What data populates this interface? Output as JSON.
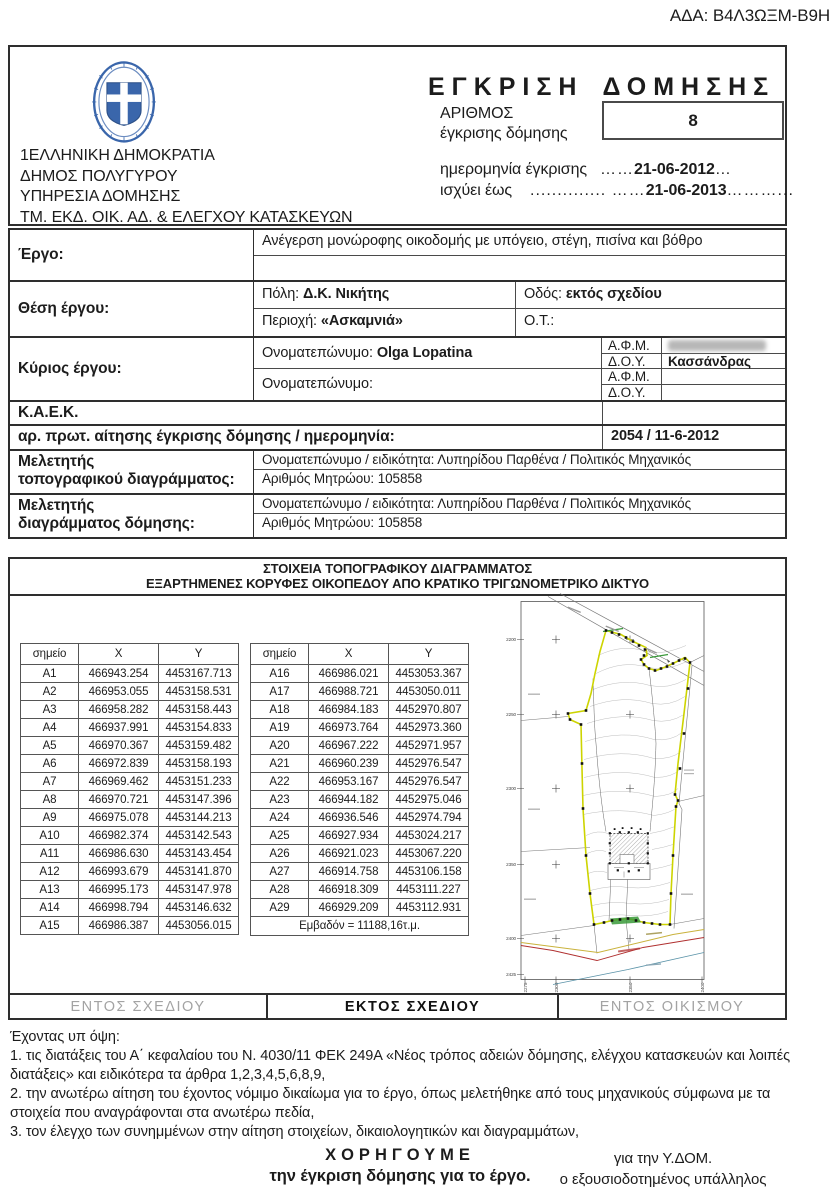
{
  "ada": "ΑΔΑ: Β4Λ3ΩΞΜ-Β9Η",
  "header": {
    "authority_lines": [
      "1ΕΛΛΗΝΙΚΗ ΔΗΜΟΚΡΑΤΙΑ",
      "ΔΗΜΟΣ ΠΟΛΥΓΥΡΟΥ",
      "ΥΠΗΡΕΣΙΑ ΔΟΜΗΣΗΣ",
      "ΤΜ. ΕΚΔ. ΟΙΚ. ΑΔ. & ΕΛΕΓΧΟΥ ΚΑΤΑΣΚΕΥΩΝ"
    ],
    "title": "ΕΓΚΡΙΣΗ ΔΟΜΗΣΗΣ",
    "number_label_1": "ΑΡΙΘΜΟΣ",
    "number_label_2": "έγκρισης δόμησης",
    "number_value": "8",
    "date1_label": "ημερομηνία έγκρισης",
    "date1_pre": "……",
    "date1_value": "21-06-2012",
    "date1_post": "…",
    "date2_label": "ισχύει έως",
    "date2_gap": "..............",
    "date2_pre": "  ……",
    "date2_value": "21-06-2013",
    "date2_post": "………..."
  },
  "info": {
    "ergo_label": "Έργο:",
    "ergo_value": "Ανέγερση μονώροφης οικοδομής με υπόγειο, στέγη,  πισίνα και βόθρο",
    "thesi_label": "Θέση έργου:",
    "poli_label": "Πόλη:",
    "poli_value": "Δ.Κ. Νικήτης",
    "odos_label": "Οδός:",
    "odos_value": "εκτός σχεδίου",
    "periochi_label": "Περιοχή:",
    "periochi_value": "«Ασκαμνιά»",
    "ot_label": "Ο.Τ.:",
    "kyrios_label": "Κύριος έργου:",
    "onoma_label": "Ονοματεπώνυμο:",
    "onoma_value": "Olga Lopatina",
    "onoma2_label": "Ονοματεπώνυμο:",
    "afm_label": "Α.Φ.Μ.",
    "doy_label": "Δ.Ο.Υ.",
    "doy_value": "Κασσάνδρας",
    "afm2_label": "Α.Φ.Μ.",
    "doy2_label": "Δ.Ο.Υ.",
    "kaek_label": "Κ.Α.Ε.Κ.",
    "prot_label": "αρ. πρωτ. αίτησης έγκρισης δόμησης / ημερομηνία:",
    "prot_value": "2054 / 11-6-2012",
    "mel1_label_1": "Μελετητής",
    "mel1_label_2": "τοπογραφικού διαγράμματος:",
    "mel1_line1": "Ονοματεπώνυμο / ειδικότητα: Λυπηρίδου Παρθένα / Πολιτικός Μηχανικός",
    "mel1_line2": "Αριθμός Μητρώου: 105858",
    "mel2_label_1": "Μελετητής",
    "mel2_label_2": "διαγράμματος δόμησης:",
    "mel2_line1": "Ονοματεπώνυμο / ειδικότητα: Λυπηρίδου Παρθένα / Πολιτικός Μηχανικός",
    "mel2_line2": "Αριθμός Μητρώου: 105858"
  },
  "topo": {
    "title1": "ΣΤΟΙΧΕΙΑ ΤΟΠΟΓΡΑΦΙΚΟΥ ΔΙΑΓΡΑΜΜΑΤΟΣ",
    "title2": "ΕΞΑΡΤΗΜΕΝΕΣ ΚΟΡΥΦΕΣ ΟΙΚΟΠΕΔΟΥ ΑΠΟ ΚΡΑΤΙΚΟ ΤΡΙΓΩΝΟΜΕΤΡΙΚΟ ΔΙΚΤΥΟ",
    "col_headers": [
      "σημείο",
      "X",
      "Y"
    ],
    "table1": [
      [
        "A1",
        "466943.254",
        "4453167.713"
      ],
      [
        "A2",
        "466953.055",
        "4453158.531"
      ],
      [
        "A3",
        "466958.282",
        "4453158.443"
      ],
      [
        "A4",
        "466937.991",
        "4453154.833"
      ],
      [
        "A5",
        "466970.367",
        "4453159.482"
      ],
      [
        "A6",
        "466972.839",
        "4453158.193"
      ],
      [
        "A7",
        "466969.462",
        "4453151.233"
      ],
      [
        "A8",
        "466970.721",
        "4453147.396"
      ],
      [
        "A9",
        "466975.078",
        "4453144.213"
      ],
      [
        "A10",
        "466982.374",
        "4453142.543"
      ],
      [
        "A11",
        "466986.630",
        "4453143.454"
      ],
      [
        "A12",
        "466993.679",
        "4453141.870"
      ],
      [
        "A13",
        "466995.173",
        "4453147.978"
      ],
      [
        "A14",
        "466998.794",
        "4453146.632"
      ],
      [
        "A15",
        "466986.387",
        "4453056.015"
      ]
    ],
    "table2": [
      [
        "A16",
        "466986.021",
        "4453053.367"
      ],
      [
        "A17",
        "466988.721",
        "4453050.011"
      ],
      [
        "A18",
        "466984.183",
        "4452970.807"
      ],
      [
        "A19",
        "466973.764",
        "4452973.360"
      ],
      [
        "A20",
        "466967.222",
        "4452971.957"
      ],
      [
        "A21",
        "466960.239",
        "4452976.547"
      ],
      [
        "A22",
        "466953.167",
        "4452976.547"
      ],
      [
        "A23",
        "466944.182",
        "4452975.046"
      ],
      [
        "A24",
        "466936.546",
        "4452974.794"
      ],
      [
        "A25",
        "466927.934",
        "4453024.217"
      ],
      [
        "A26",
        "466921.023",
        "4453067.220"
      ],
      [
        "A27",
        "466914.758",
        "4453106.158"
      ],
      [
        "A28",
        "466918.309",
        "4453111.227"
      ],
      [
        "A29",
        "466929.209",
        "4453112.931"
      ]
    ],
    "area_label": "Εμβαδόν = 11188,16τ.μ.",
    "map": {
      "y_ticks": [
        "2200",
        "2250",
        "2300",
        "2350",
        "2400",
        "2425"
      ],
      "x_ticks": [
        "2275",
        "2300",
        "2350",
        "2400"
      ]
    }
  },
  "zones": {
    "left": "ΕΝΤΟΣ ΣΧΕΔΙΟΥ",
    "center": "ΕΚΤΟΣ ΣΧΕΔΙΟΥ",
    "right": "ΕΝΤΟΣ ΟΙΚΙΣΜΟΥ"
  },
  "footer": {
    "intro": "Έχοντας υπ όψη:",
    "items": [
      "1. τις διατάξεις του Α΄ κεφαλαίου του Ν. 4030/11 ΦΕΚ 249Α «Νέος τρόπος αδειών δόμησης, ελέγχου κατασκευών και λοιπές διατάξεις» και ειδικότερα τα άρθρα 1,2,3,4,5,6,8,9,",
      "2. την ανωτέρω αίτηση του έχοντος νόμιμο δικαίωμα για το έργο, όπως μελετήθηκε από τους μηχανικούς σύμφωνα με τα στοιχεία που αναγράφονται στα ανωτέρω πεδία,",
      "3. τον έλεγχο των συνημμένων στην αίτηση στοιχείων, δικαιολογητικών και διαγραμμάτων,"
    ],
    "grant_title": "ΧΟΡΗΓΟΥΜΕ",
    "grant_text": "την έγκριση δόμησης για το έργο.",
    "sign_line_1": "για την Υ.ΔΟΜ.",
    "sign_line_2": "ο εξουσιοδοτημένος υπάλληλος"
  },
  "colors": {
    "emblem_blue": "#3a66ab",
    "parcel_boundary": "#cdd400",
    "vegetation_green": "#3a9a3a",
    "road_red": "#b03030",
    "road_yellow": "#c9b23c",
    "stream_blue": "#5a93a8",
    "muted_grey": "#a3a3a3"
  }
}
